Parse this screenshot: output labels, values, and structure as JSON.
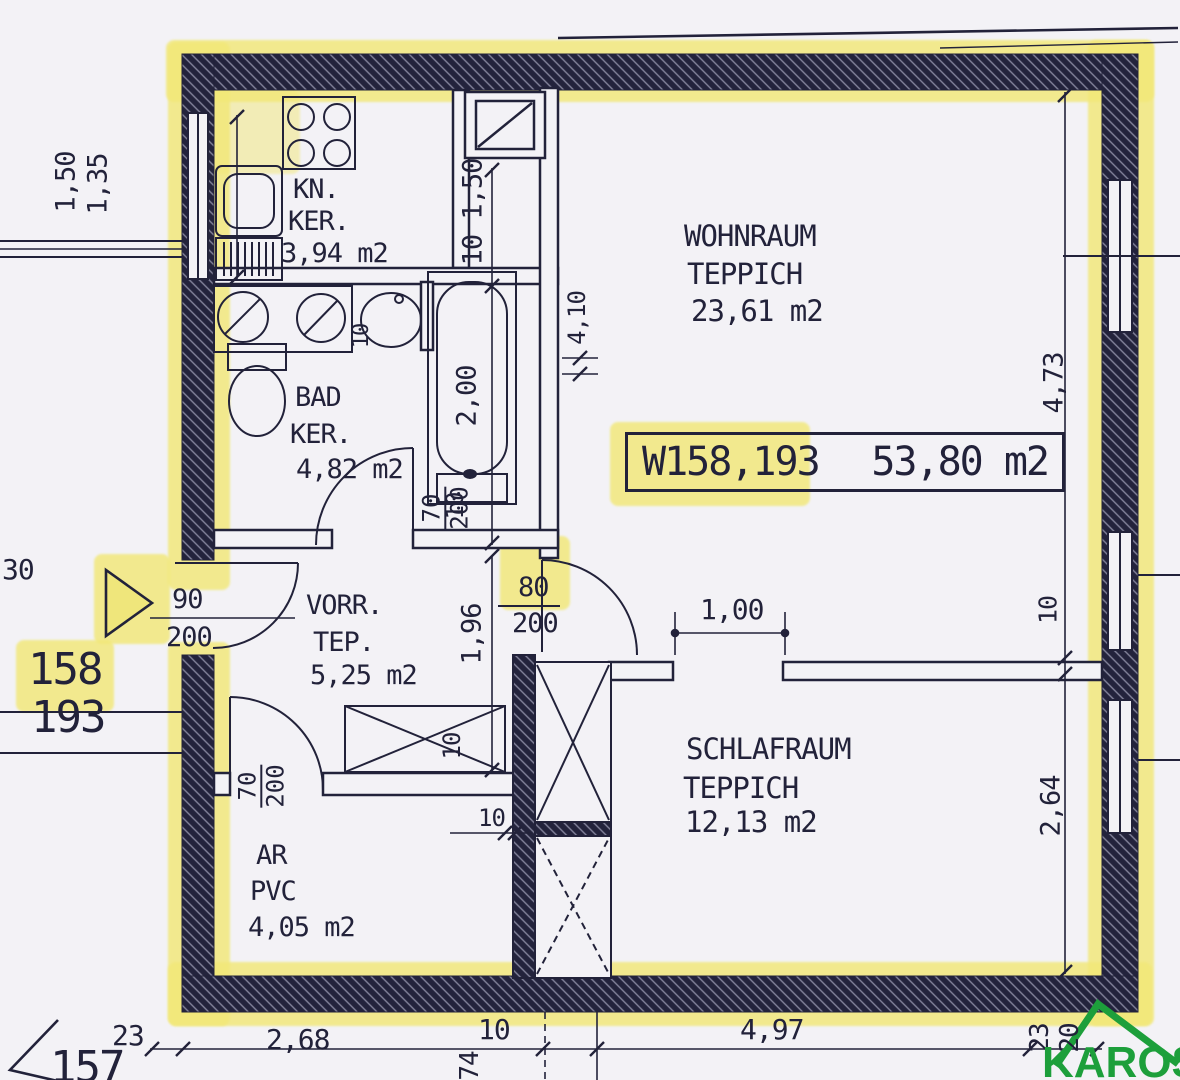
{
  "palette": {
    "highlight": "#f2e878",
    "ink": "#22223a",
    "logo_green": "#1d9f3b",
    "paper": "#f3f2f6"
  },
  "rooms": {
    "kn": {
      "name": "KN.",
      "floor": "KER.",
      "area": "3,94 m2"
    },
    "bad": {
      "name": "BAD",
      "floor": "KER.",
      "area": "4,82 m2"
    },
    "vorr": {
      "name": "VORR.",
      "floor": "TEP.",
      "area": "5,25 m2"
    },
    "ar": {
      "name": "AR",
      "floor": "PVC",
      "area": "4,05 m2"
    },
    "wohnraum": {
      "name": "WOHNRAUM",
      "floor": "TEPPICH",
      "area": "23,61 m2"
    },
    "schlafraum": {
      "name": "SCHLAFRAUM",
      "floor": "TEPPICH",
      "area": "12,13 m2"
    }
  },
  "unit_label": {
    "code": "W158,193",
    "area": "53,80 m2"
  },
  "unit_numbers": {
    "upper": "158",
    "lower": "193"
  },
  "adjacent_unit": "157",
  "left_edge_label": "30",
  "doors": {
    "entry": {
      "w": "90",
      "h": "200"
    },
    "bad": {
      "w": "70",
      "h": "200"
    },
    "ar": {
      "w": "70",
      "h": "200"
    },
    "schlafraum": {
      "w": "80",
      "h": "200"
    }
  },
  "dims": {
    "left_window_a": "1,50",
    "left_window_b": "1,35",
    "kitchen_chain": "10 1,50",
    "vorr_height": "1,96",
    "tub": "2,00",
    "tub_end": "10",
    "bath_small": "10",
    "niche": "4,10",
    "opening": "1,00",
    "right_top": "4,73",
    "right_mid": "10",
    "right_bottom": "2,64",
    "bottom_wall": "23",
    "bottom_ar": "2,68",
    "bottom_shaft": "10",
    "bottom_rot": "74",
    "bottom_schlaf": "4,97",
    "corner_a": "23",
    "corner_b": "20",
    "closet": "10",
    "ar_wall": "10"
  },
  "logo": {
    "text": "KAROS"
  }
}
